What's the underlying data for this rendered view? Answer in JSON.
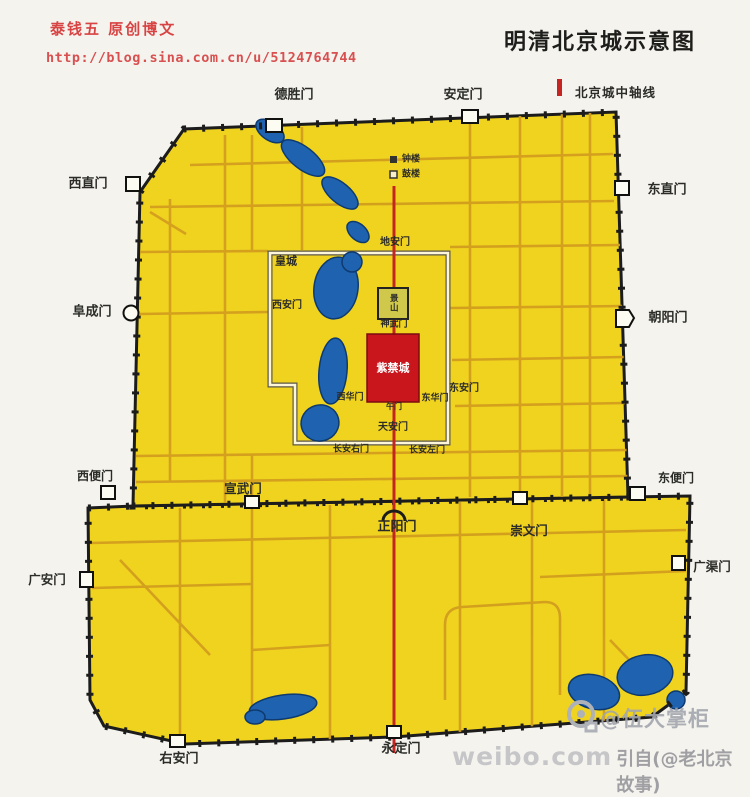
{
  "header": {
    "author_line": "泰钱五 原创博文",
    "blog_url": "http://blog.sina.com.cn/u/5124764744",
    "title": "明清北京城示意图",
    "legend_label": "北京城中轴线",
    "legend_color": "#c42521"
  },
  "map": {
    "colors": {
      "city_yellow": "#f0d31f",
      "street_orange": "#d29e1e",
      "wall_black": "#1c1c1c",
      "water_blue": "#1f63b0",
      "axis_red": "#c42521",
      "forbidden_city_red": "#c9151c",
      "label_dark": "#2b2b28"
    },
    "labels": [
      {
        "name": "gate-label-deshengmen",
        "text": "德胜门",
        "x": 294,
        "y": 95,
        "size": 13
      },
      {
        "name": "gate-label-andingmen",
        "text": "安定门",
        "x": 463,
        "y": 95,
        "size": 13
      },
      {
        "name": "gate-label-xizhimen",
        "text": "西直门",
        "x": 88,
        "y": 184,
        "size": 13
      },
      {
        "name": "gate-label-dongzhimen",
        "text": "东直门",
        "x": 667,
        "y": 190,
        "size": 13
      },
      {
        "name": "gate-label-fuchengmen",
        "text": "阜成门",
        "x": 92,
        "y": 312,
        "size": 13
      },
      {
        "name": "gate-label-chaoyangmen",
        "text": "朝阳门",
        "x": 668,
        "y": 318,
        "size": 13
      },
      {
        "name": "gate-label-xibianmen",
        "text": "西便门",
        "x": 95,
        "y": 476,
        "size": 12
      },
      {
        "name": "gate-label-dongbianmen",
        "text": "东便门",
        "x": 676,
        "y": 478,
        "size": 12
      },
      {
        "name": "gate-label-guanganmen",
        "text": "广安门",
        "x": 47,
        "y": 580,
        "size": 12.5
      },
      {
        "name": "gate-label-guangqumen",
        "text": "广渠门",
        "x": 712,
        "y": 567,
        "size": 12.5
      },
      {
        "name": "gate-label-xuanwumen",
        "text": "宣武门",
        "x": 243,
        "y": 489,
        "size": 12.5
      },
      {
        "name": "gate-label-zhengyangmen",
        "text": "正阳门",
        "x": 397,
        "y": 527,
        "size": 13
      },
      {
        "name": "gate-label-chongwenmen",
        "text": "崇文门",
        "x": 529,
        "y": 531,
        "size": 12.5
      },
      {
        "name": "gate-label-youanmen",
        "text": "右安门",
        "x": 179,
        "y": 759,
        "size": 13
      },
      {
        "name": "gate-label-yongdingmen",
        "text": "永定门",
        "x": 401,
        "y": 749,
        "size": 13
      },
      {
        "name": "label-huangcheng",
        "text": "皇城",
        "x": 286,
        "y": 261,
        "size": 11
      },
      {
        "name": "gate-label-dianmen",
        "text": "地安门",
        "x": 395,
        "y": 243,
        "size": 10
      },
      {
        "name": "gate-label-xianmen",
        "text": "西安门",
        "x": 287,
        "y": 306,
        "size": 10
      },
      {
        "name": "gate-label-donganmen",
        "text": "东安门",
        "x": 464,
        "y": 389,
        "size": 10
      },
      {
        "name": "gate-label-shenwumen",
        "text": "神武门",
        "x": 394,
        "y": 325,
        "size": 9
      },
      {
        "name": "gate-label-wumen",
        "text": "午门",
        "x": 394,
        "y": 407,
        "size": 8
      },
      {
        "name": "gate-label-xihuamen",
        "text": "西华门",
        "x": 350,
        "y": 398,
        "size": 9
      },
      {
        "name": "gate-label-donghuamen",
        "text": "东华门",
        "x": 435,
        "y": 399,
        "size": 9
      },
      {
        "name": "gate-label-tiananmen",
        "text": "天安门",
        "x": 393,
        "y": 428,
        "size": 10
      },
      {
        "name": "gate-label-changanyoumen",
        "text": "长安右门",
        "x": 351,
        "y": 450,
        "size": 9
      },
      {
        "name": "gate-label-changanzuomen",
        "text": "长安左门",
        "x": 427,
        "y": 451,
        "size": 9
      },
      {
        "name": "label-zhonglou",
        "text": "钟楼",
        "x": 411,
        "y": 160,
        "size": 9
      },
      {
        "name": "label-gulou",
        "text": "鼓楼",
        "x": 411,
        "y": 175,
        "size": 9
      },
      {
        "name": "label-jingshan",
        "text": "景山",
        "x": 393,
        "y": 303,
        "size": 8.5,
        "vertical": true
      },
      {
        "name": "label-zijincheng",
        "text": "紫禁城",
        "x": 393,
        "y": 368,
        "size": 11,
        "color": "#ffffff"
      }
    ]
  },
  "watermark": {
    "line1": "@伍大掌柜",
    "line2_site": "weibo.com",
    "line2_credit": "引自(@老北京故事)"
  }
}
